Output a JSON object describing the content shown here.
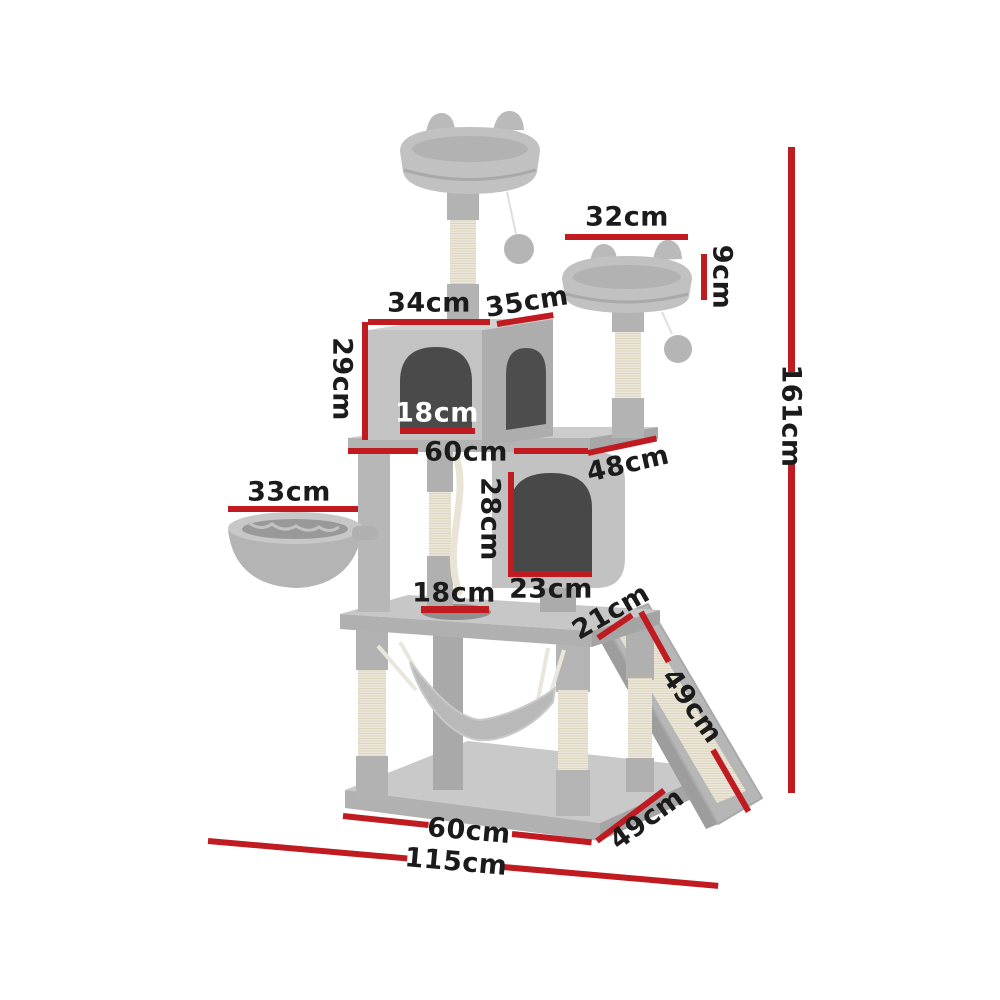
{
  "diagram": {
    "type": "product-dimension-diagram",
    "subject": "cat tree scratching post tower",
    "unit": "cm"
  },
  "colors": {
    "background": "#ffffff",
    "dimension_line_red": "#bf1b20",
    "label_black": "#1b1b1b",
    "label_white": "#ffffff",
    "plush_gray": "#c2c2c2",
    "plush_shadow_gray": "#a8a8a8",
    "sisal_cream": "#ece7da",
    "interior_dark_gray": "#4a4a4a"
  },
  "dimensions": {
    "top_perch_width": "32cm",
    "small_perch_height": "9cm",
    "condo_front_width": "34cm",
    "condo_side_depth": "35cm",
    "condo_height": "29cm",
    "condo_door_width": "18cm",
    "mid_platform_width": "60cm",
    "mid_platform_depth": "48cm",
    "basket_width": "33cm",
    "lower_condo_door_height": "28cm",
    "lower_condo_door_width": "23cm",
    "platform_hole_width": "18cm",
    "ramp_width": "21cm",
    "ramp_length": "49cm",
    "total_height": "161cm",
    "base_width": "60cm",
    "base_depth": "49cm",
    "total_footprint_width": "115cm"
  }
}
